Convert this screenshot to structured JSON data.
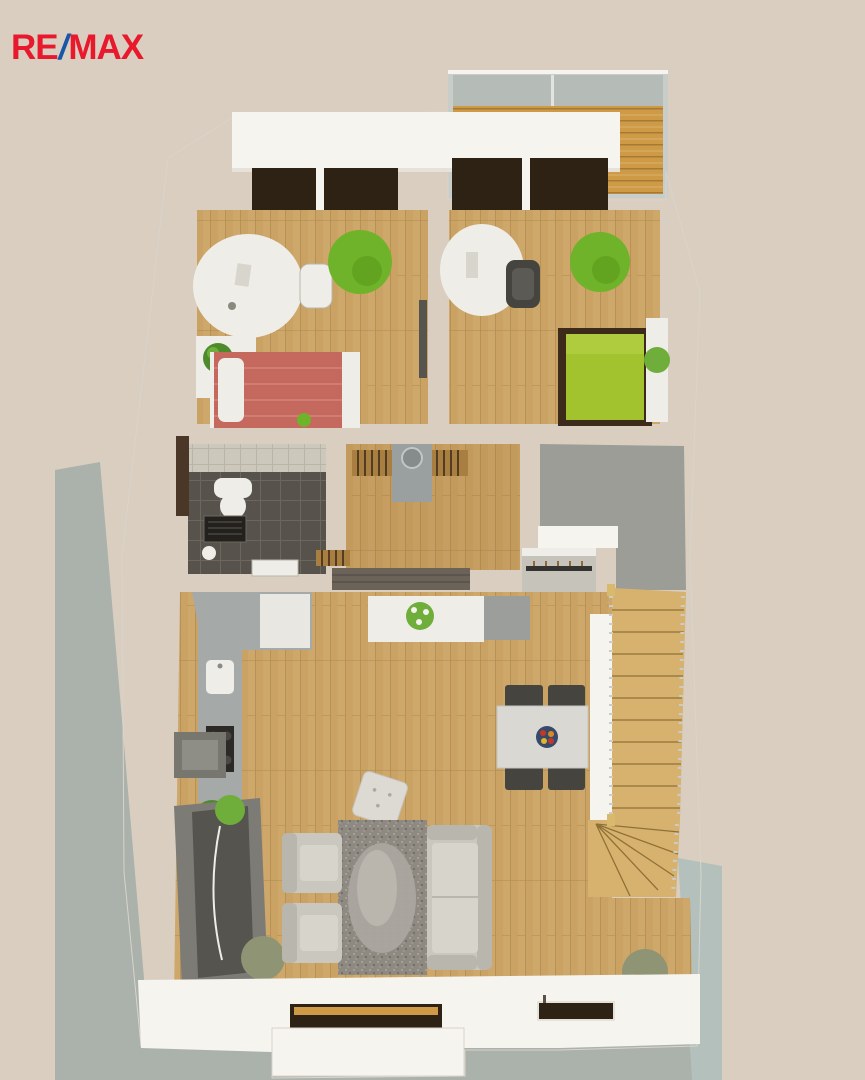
{
  "logo": {
    "re": "RE",
    "slash": "/",
    "max": "MAX"
  },
  "scene": {
    "description": "3D top-down architectural floor plan render of an apartment",
    "rooms": [
      "balcony",
      "bedroom-left",
      "bedroom-right",
      "bathroom",
      "hallway",
      "storage-room",
      "wardrobe",
      "kitchen",
      "living-room",
      "dining-area",
      "staircase",
      "terrace"
    ]
  },
  "palette": {
    "bg": "#d9cec0",
    "ground": "#abb1ab",
    "ground2": "#b3c0bb",
    "wall": "#f6f4ef",
    "wall-shade": "#e6e2da",
    "wall-edge": "#d9d4cb",
    "wood": "#c9a264",
    "wood-line": "#b08a4e",
    "wood-light": "#ddb97e",
    "deck": "#cf9a46",
    "deck-line": "#9c7231",
    "glass": "#b5bbb7",
    "rail": "#c9cdca",
    "frame-dark": "#2e2215",
    "slat": "#a87e41",
    "red-bed": "#c5695f",
    "red-bed-light": "#d07d74",
    "white-furn": "#efede7",
    "green-bed": "#a3c32e",
    "bed-frame": "#3c2b1a",
    "beanbag": "#6fb32a",
    "beanbag-dark": "#579718",
    "tile-dark": "#57524b",
    "tile-grout": "#6b665e",
    "tile-light": "#ccc8bb",
    "tile-light-line": "#bab5a8",
    "carpet": "#9c9d97",
    "counter": "#a5a9a8",
    "cabinet": "#e9e7e2",
    "hood": "#77766f",
    "hood-light": "#8e8d86",
    "cooktop": "#2b2a27",
    "stairs": "#d7b26e",
    "stairs-line": "#8f7136",
    "rail-metal": "#c9ccc9",
    "post": "#d9ba6c",
    "sofa": "#cac7bf",
    "sofa-shade": "#b9b6ae",
    "seat": "#d7d4cc",
    "rug": "#8e8a82",
    "rug-light": "#a7a39b",
    "rug-dark": "#6d6962",
    "oval": "#aba79f",
    "oval-hi": "#c2beb5",
    "table": "#d9d8d3",
    "chair": "#45443f",
    "sideboard": "#6b6258",
    "tv-unit": "#7c7b75",
    "tv-screen": "#55544e",
    "door": "#4a3727",
    "plant": "#4c8a2b",
    "plant-bright": "#6fae3a",
    "plant-olive": "#8f9474",
    "bowl": "#39496b",
    "fruit-red": "#c03a2a",
    "fruit-orange": "#d98a1f",
    "fruit-yellow": "#e0b52a",
    "paper": "#d8d5cd",
    "logo-red": "#e8192c",
    "logo-blue": "#1a56a8"
  }
}
